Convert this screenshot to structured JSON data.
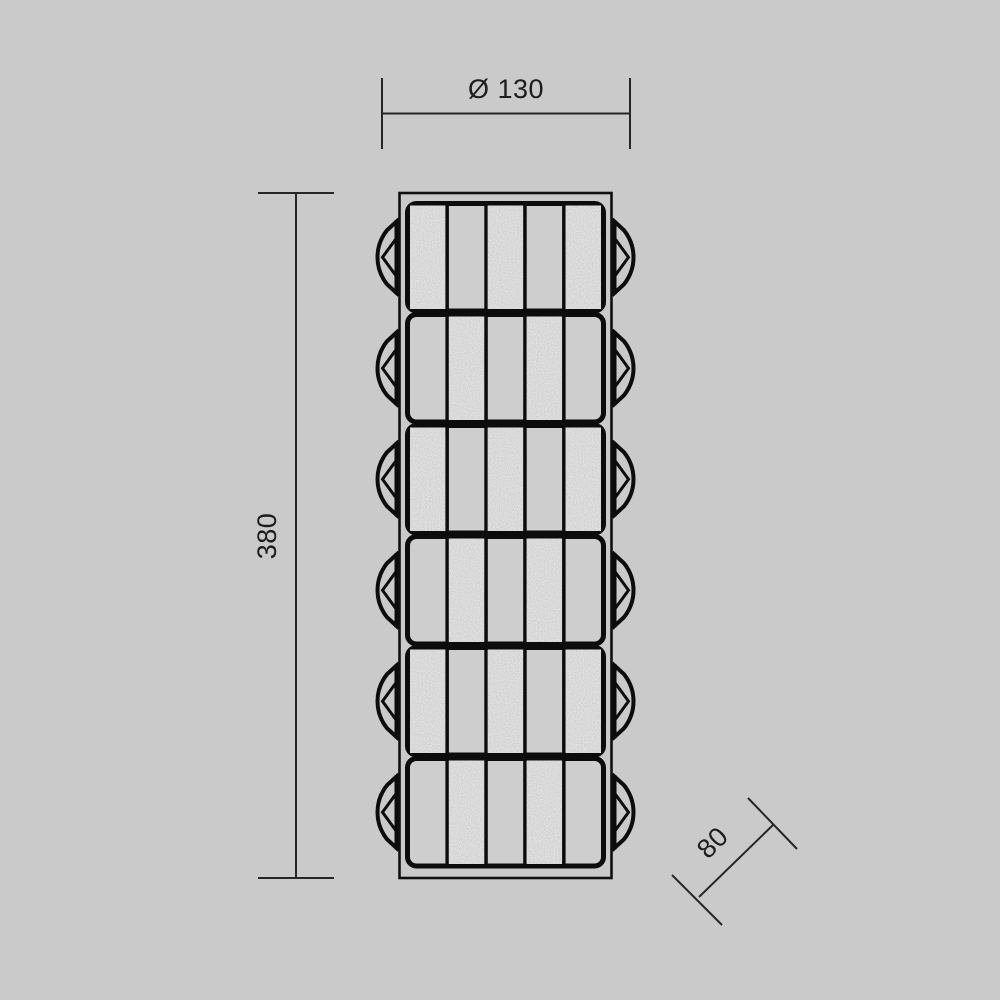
{
  "page": {
    "background_color": "#cacaca"
  },
  "drawing": {
    "name": "segmented-cylindrical-lamp-technical-drawing",
    "dimensions": {
      "diameter": {
        "label": "Ø 130"
      },
      "height": {
        "label": "380"
      },
      "depth": {
        "label": "80"
      }
    },
    "fixture": {
      "segment_count": 6,
      "bars_per_segment": 5,
      "segments": [
        {
          "bars": [
            "textured",
            "plain",
            "textured",
            "plain",
            "textured"
          ]
        },
        {
          "bars": [
            "plain",
            "textured",
            "plain",
            "textured",
            "plain"
          ]
        },
        {
          "bars": [
            "textured",
            "plain",
            "textured",
            "plain",
            "textured"
          ]
        },
        {
          "bars": [
            "plain",
            "textured",
            "plain",
            "textured",
            "plain"
          ]
        },
        {
          "bars": [
            "textured",
            "plain",
            "textured",
            "plain",
            "textured"
          ]
        },
        {
          "bars": [
            "plain",
            "textured",
            "plain",
            "textured",
            "plain"
          ]
        }
      ],
      "colors": {
        "outline": "#0c0c0c",
        "housing_stroke": "#101010",
        "plain_bar": "#cecece",
        "textured_bar": "#b3b3b3",
        "dimension_line": "#262626",
        "text": "#1c1c1c"
      }
    }
  }
}
